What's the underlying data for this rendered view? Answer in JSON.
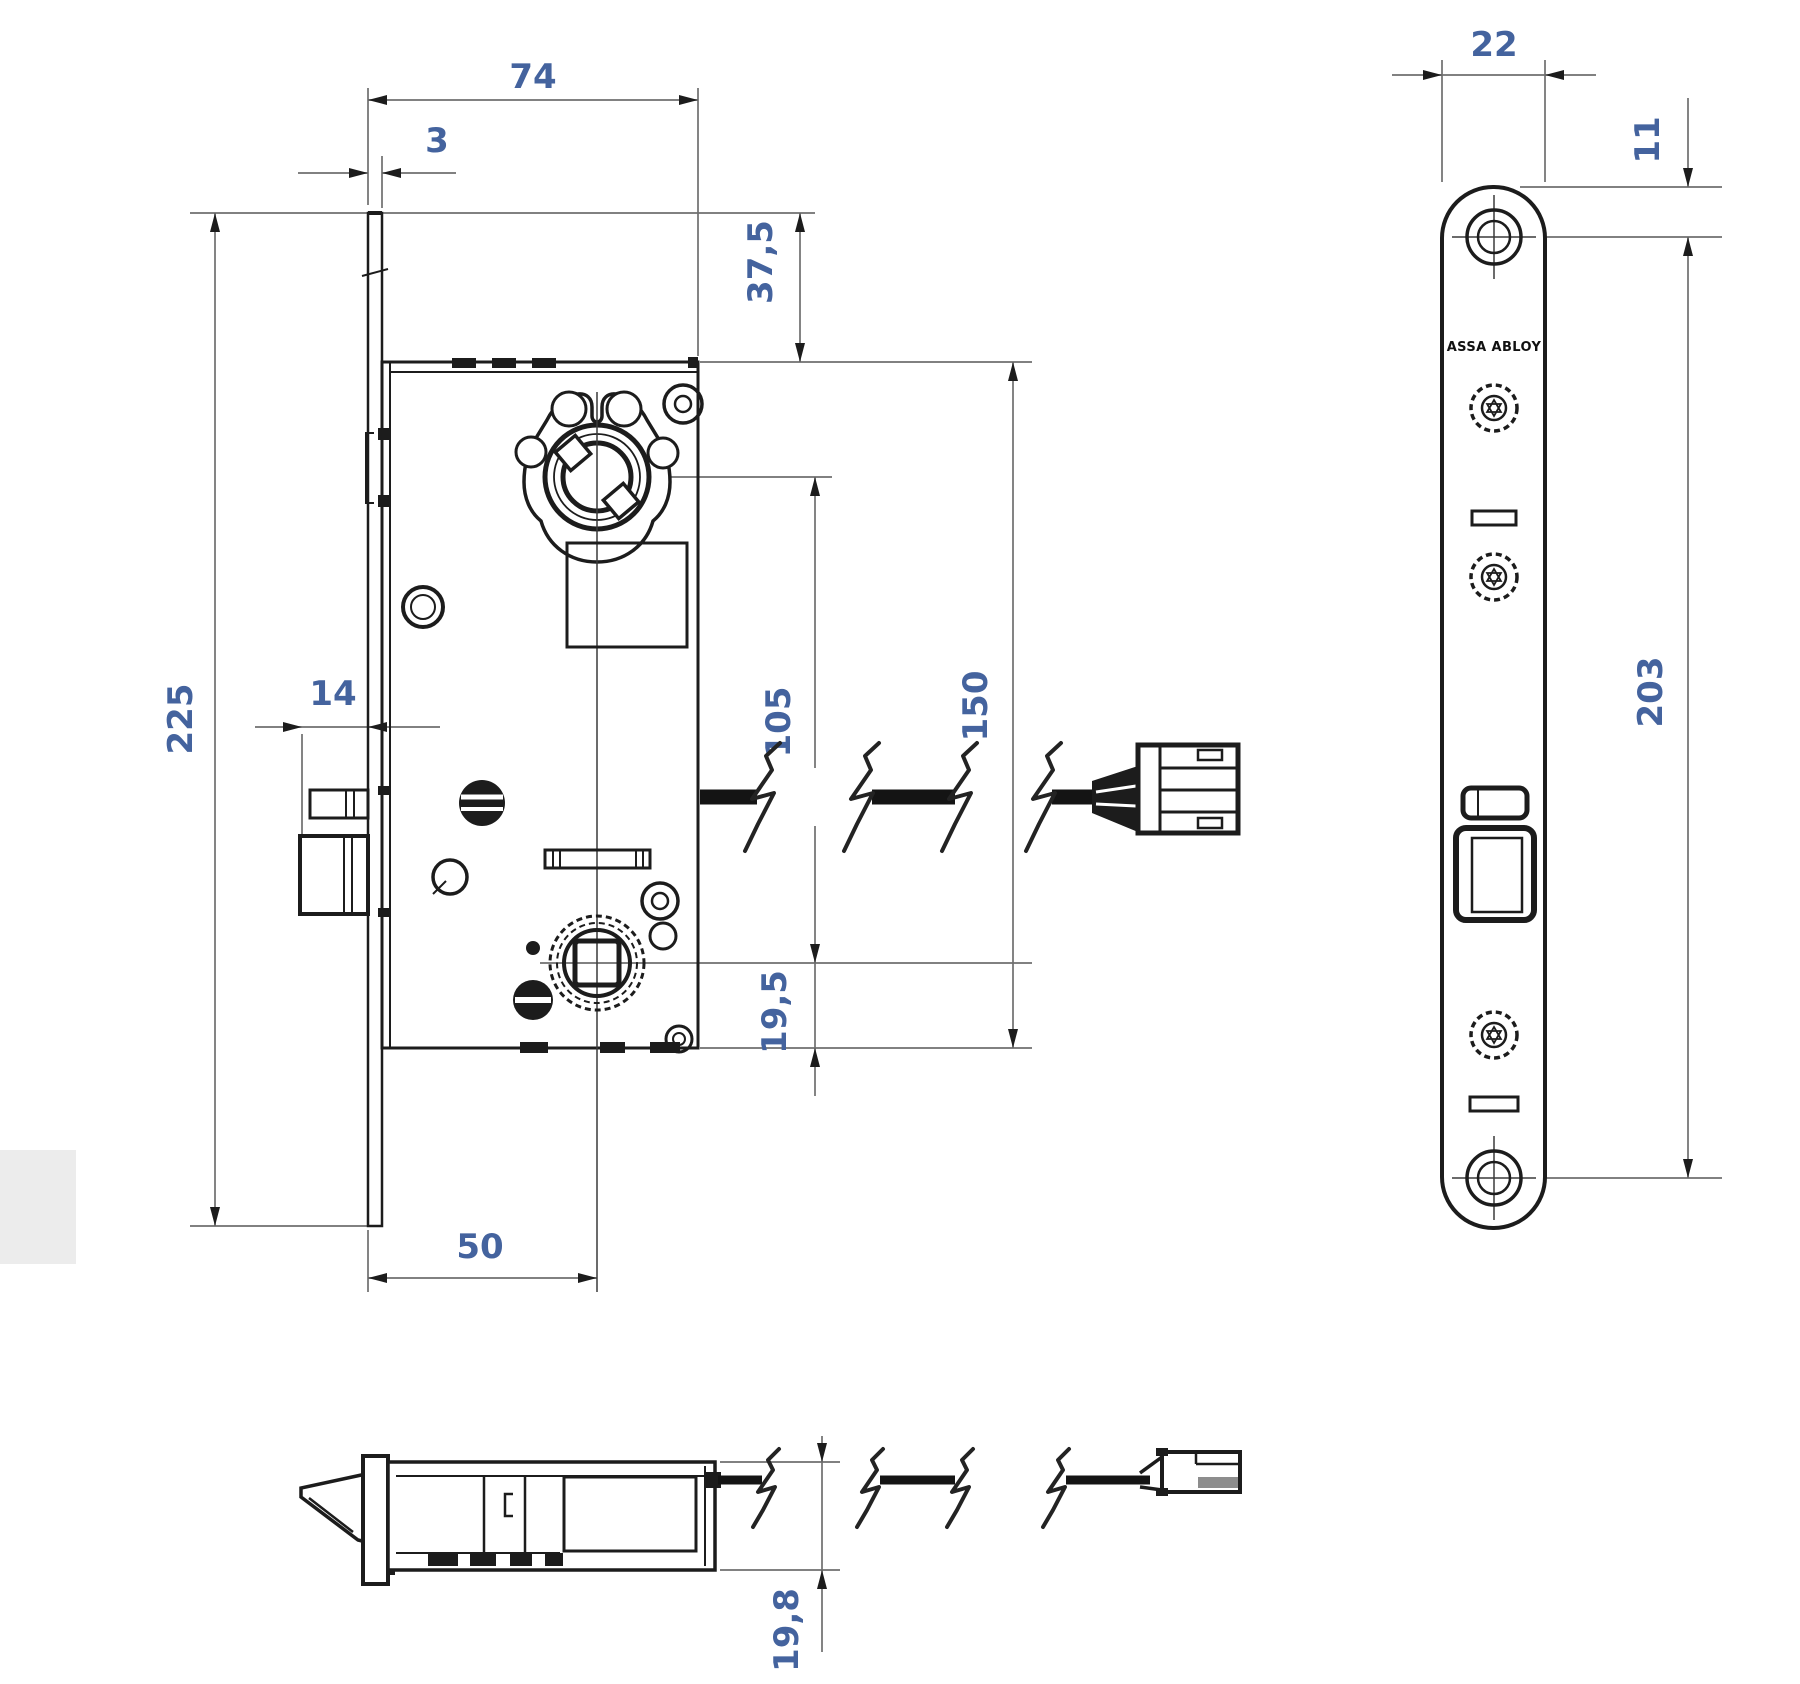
{
  "drawing": {
    "logo_text": "ASSA ABLOY",
    "dimensions": {
      "case_depth": "74",
      "faceplate_thickness": "3",
      "top_to_case": "37,5",
      "faceplate_length": "225",
      "latch_projection": "14",
      "hub_to_spindle": "105",
      "case_height": "150",
      "spindle_to_case_bottom": "19,5",
      "backset": "50",
      "faceplate_width": "22",
      "top_to_first_screw": "11",
      "screw_centers": "203",
      "case_thickness": "19,8"
    },
    "colors": {
      "object_line": "#1c1c1c",
      "dimension_line": "#6f6f6f",
      "dimension_text": "#44639e",
      "background": "#ffffff"
    }
  }
}
